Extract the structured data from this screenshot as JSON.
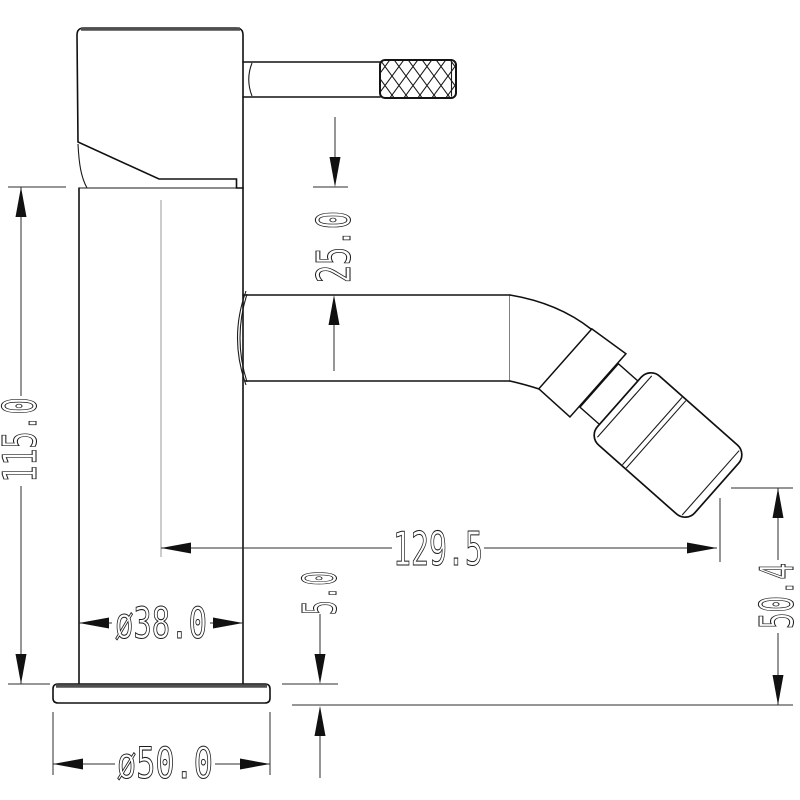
{
  "drawing": {
    "dimensions": {
      "overall_height": "115.0",
      "handle_to_spout": "25.0",
      "spout_reach": "129.5",
      "outlet_to_base": "50.4",
      "base_thickness": "5.0",
      "body_diameter": "ø38.0",
      "base_diameter": "ø50.0"
    },
    "colors": {
      "background": "#ffffff",
      "outline": "#111111",
      "dimension_lines": "#2e2e2e",
      "shaded_edge": "#4f4f4f",
      "centerline": "#999999"
    }
  }
}
